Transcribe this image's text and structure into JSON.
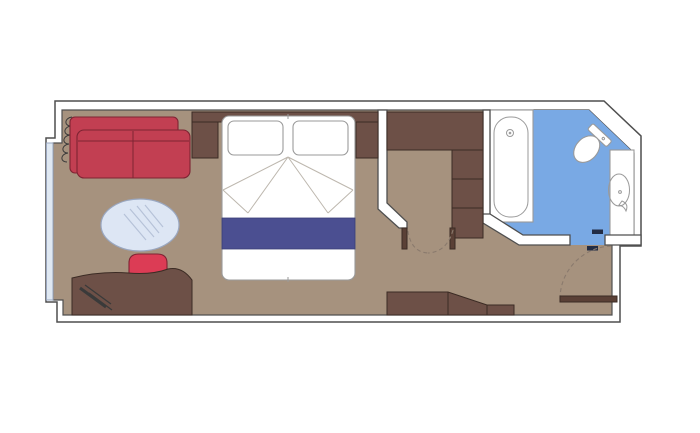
{
  "diagram": {
    "type": "floorplan",
    "subject": "cruise-ship-cabin",
    "rooms": [
      "living-area",
      "sleeping-area",
      "dressing-area",
      "bathroom",
      "entry-hall"
    ],
    "elements": [
      "window",
      "curtain-coil",
      "sofa",
      "coffee-table",
      "desk",
      "desk-chair",
      "headboard-shelf",
      "nightstand-left",
      "nightstand-right",
      "double-bed",
      "pillows",
      "bed-runner",
      "wardrobe-cabinet",
      "wardrobe-shelves",
      "dressing-door-jambs",
      "dressing-door-swing",
      "dresser-unit",
      "bathtub",
      "toilet",
      "sink",
      "vanity-counter",
      "bathroom-door-hardware",
      "entrance-door",
      "entrance-door-swing"
    ]
  },
  "colors": {
    "background": "#ffffff",
    "wall_fill": "#ffffff",
    "wall_line": "#4f4f4f",
    "floor": "#a6927e",
    "wood": "#6d5047",
    "wood_dark": "#5a4036",
    "wood_line": "#3b2b24",
    "sofa_red": "#c23f52",
    "chair_red": "#dc3c55",
    "sofa_line": "#7e2433",
    "bed_runner_navy": "#4b4f91",
    "bathroom_blue": "#79a9e4",
    "window_glass": "#dfe8f2",
    "table_glass": "#dde6f4",
    "fixture_white": "#ffffff",
    "fixture_line": "#9a9a9a",
    "dash_line": "#8a7a6d",
    "door_hardware": "#222c44"
  }
}
